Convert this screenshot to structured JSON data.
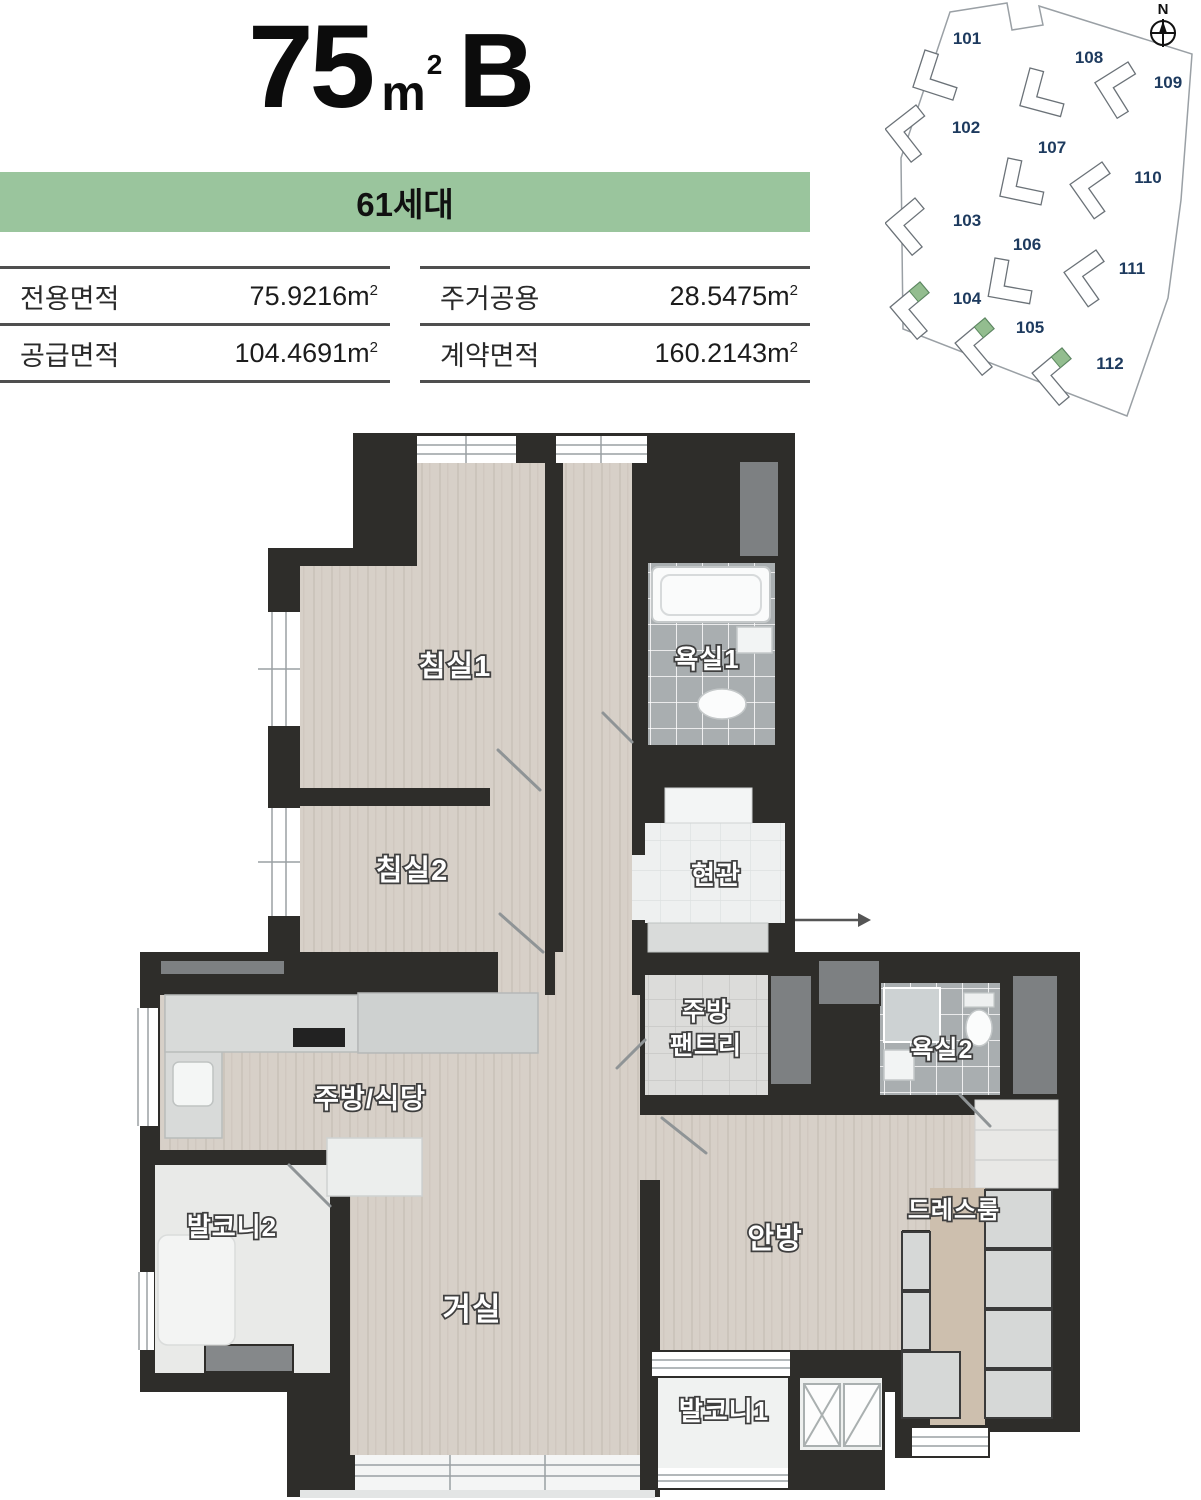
{
  "header": {
    "title_number": "75",
    "title_unit_base": "m",
    "title_unit_sup": "2",
    "title_suffix": "B",
    "banner": "61세대"
  },
  "area_table": {
    "unit_base": "m",
    "unit_sup": "2",
    "left": [
      {
        "label": "전용면적",
        "value": "75.9216"
      },
      {
        "label": "공급면적",
        "value": "104.4691"
      }
    ],
    "right": [
      {
        "label": "주거공용",
        "value": "28.5475"
      },
      {
        "label": "계약면적",
        "value": "160.2143"
      }
    ]
  },
  "site_map": {
    "compass_label": "N",
    "label_color": "#1d3a5e",
    "highlight_color": "#93bd8f",
    "buildings": [
      {
        "id": "101",
        "highlighted": false
      },
      {
        "id": "108",
        "highlighted": false
      },
      {
        "id": "109",
        "highlighted": false
      },
      {
        "id": "102",
        "highlighted": false
      },
      {
        "id": "107",
        "highlighted": false
      },
      {
        "id": "110",
        "highlighted": false
      },
      {
        "id": "103",
        "highlighted": false
      },
      {
        "id": "106",
        "highlighted": false
      },
      {
        "id": "111",
        "highlighted": false
      },
      {
        "id": "104",
        "highlighted": true
      },
      {
        "id": "105",
        "highlighted": true
      },
      {
        "id": "112",
        "highlighted": true
      }
    ]
  },
  "floor_plan": {
    "wall_color": "#2e2d2a",
    "rooms": {
      "bedroom1": "침실1",
      "bath1": "욕실1",
      "bedroom2": "침실2",
      "entrance": "현관",
      "pantry_line1": "주방",
      "pantry_line2": "팬트리",
      "bath2": "욕실2",
      "kitchen": "주방/식당",
      "balcony2": "발코니2",
      "dressroom": "드레스룸",
      "master": "안방",
      "living": "거실",
      "balcony1": "발코니1"
    },
    "icons": {
      "compass": "compass-rose-icon",
      "entrance_arrow": "entrance-direction-arrow-icon"
    }
  }
}
